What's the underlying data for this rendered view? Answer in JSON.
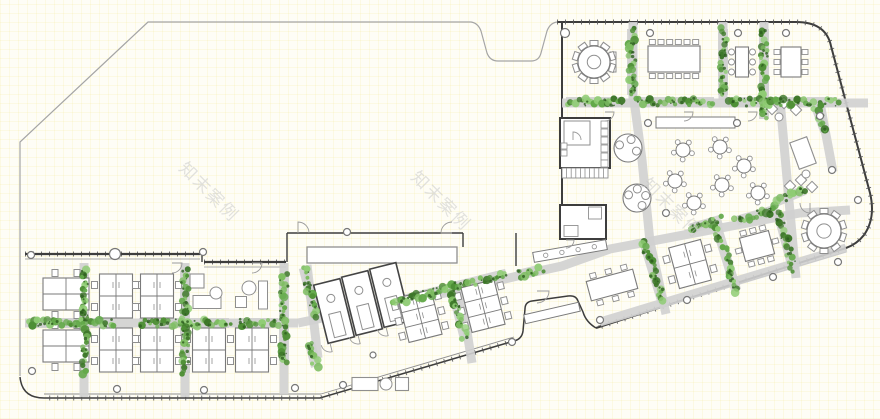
{
  "watermark": {
    "text": "知末案例",
    "color": "#c6c6c6",
    "opacity": 0.5,
    "font_size": 17,
    "rotation": 45,
    "instances": [
      [
        205,
        196
      ],
      [
        437,
        205
      ],
      [
        668,
        212
      ]
    ]
  },
  "palette": {
    "site_outline": "#a5a5a5",
    "wall_dark": "#3d3d3d",
    "wall_mid": "#555555",
    "furniture": "#8f8f8f",
    "furniture_dark": "#7a7a7a",
    "path_gray": "#d0d0d0",
    "greens": [
      "#4e8f35",
      "#63a94a",
      "#7dbd60",
      "#3c7628",
      "#8fcc74"
    ],
    "green_dark": "#2d5c1f",
    "white": "#ffffff"
  },
  "canvas": {
    "width": 880,
    "height": 419
  },
  "outline": {
    "site_path": "M20,376 L20,142 L148,22 L471,22 Q478,23 481,31 L487,53 Q490,61 498,61 L531,61 Q539,61 541,53 L547,31 Q550,23 557,22",
    "block_path": "M557,22 L796,22 Q826,22 831,46 L870,193 Q876,218 864,235 Q857,244 846,248 L596,328",
    "notch_path": "M596,328 Q586,322 583,312 L578,301 Q576,295 568,296 L532,301 Q525,302 525,309 L523,331 Q522,339 514,341",
    "bottom_path": "M514,341 L320,398 L44,398 Q22,398 20,377",
    "tick_paths": [
      "M557,22 L796,22 Q826,22 831,46 L870,193 Q876,218 864,235 Q857,244 846,248 L596,328",
      "M514,341 L320,398 L44,398",
      "M25,254 L200,254",
      "M204,262 L286,262"
    ]
  },
  "paths": [
    "M25,323 L298,323",
    "M84,263 L84,397",
    "M185,263 L185,397",
    "M284,263 L284,394",
    "M307,265 L318,358",
    "M460,288 L472,363",
    "M298,323 L455,291 L530,273 L562,266 L610,249 L800,213 L850,210",
    "M634,100 L642,160 L650,242 L666,314",
    "M780,100 L790,212 L796,278",
    "M562,103 L868,103",
    "M633,22 L633,100",
    "M723,22 L723,100",
    "M764,22 L764,100",
    "M820,103 L833,172",
    "M600,322 L846,248"
  ],
  "hedges": [
    [
      71,
      323,
      84,
      0
    ],
    [
      184,
      323,
      90,
      0
    ],
    [
      259,
      323,
      38,
      0
    ],
    [
      84,
      322,
      102,
      90
    ],
    [
      185,
      322,
      102,
      90
    ],
    [
      284,
      318,
      86,
      90
    ],
    [
      310,
      293,
      52,
      76
    ],
    [
      313,
      355,
      24,
      76
    ],
    [
      423,
      295,
      60,
      -14
    ],
    [
      458,
      311,
      58,
      76
    ],
    [
      481,
      280,
      52,
      -14
    ],
    [
      530,
      272,
      24,
      -14
    ],
    [
      653,
      271,
      64,
      73
    ],
    [
      726,
      257,
      70,
      73
    ],
    [
      786,
      242,
      58,
      75
    ],
    [
      706,
      224,
      32,
      -16
    ],
    [
      757,
      215,
      42,
      -16
    ],
    [
      790,
      196,
      32,
      -22
    ],
    [
      632,
      62,
      66,
      90
    ],
    [
      723,
      62,
      66,
      90
    ],
    [
      764,
      74,
      90,
      90
    ],
    [
      594,
      102,
      56,
      0
    ],
    [
      675,
      102,
      78,
      0
    ],
    [
      765,
      102,
      74,
      0
    ],
    [
      822,
      102,
      30,
      0
    ],
    [
      821,
      120,
      24,
      70
    ]
  ],
  "walls": [
    [
      562,
      22,
      562,
      232,
      2
    ],
    [
      25,
      254,
      200,
      254,
      2.2
    ],
    [
      25,
      259,
      200,
      259,
      0.8
    ],
    [
      202,
      254,
      202,
      262,
      1.4
    ],
    [
      204,
      262,
      286,
      262,
      2.2
    ],
    [
      204,
      267,
      286,
      267,
      0.8
    ],
    [
      287,
      233,
      287,
      262,
      1.4
    ],
    [
      287,
      233,
      463,
      233,
      1.4
    ],
    [
      463,
      233,
      463,
      247,
      1.4
    ],
    [
      335,
      247,
      335,
      263,
      0.9
    ],
    [
      370,
      247,
      370,
      263,
      0.9
    ],
    [
      406,
      247,
      406,
      263,
      0.9
    ],
    [
      432,
      247,
      432,
      263,
      0.9
    ],
    [
      310,
      259,
      454,
      259,
      0.7
    ],
    [
      516,
      233,
      516,
      266,
      1.4
    ],
    [
      846,
      252,
      598,
      326,
      0.9
    ],
    [
      514,
      337,
      321,
      394,
      0.9
    ],
    [
      321,
      394,
      44,
      394,
      0.9
    ]
  ],
  "clusters": [
    {
      "cx": 116,
      "cy": 296,
      "w": 33,
      "h": 44,
      "rot": 0,
      "rows": 2,
      "mode": "side"
    },
    {
      "cx": 157,
      "cy": 296,
      "w": 33,
      "h": 44,
      "rot": 0,
      "rows": 2,
      "mode": "side"
    },
    {
      "cx": 116,
      "cy": 350,
      "w": 33,
      "h": 44,
      "rot": 0,
      "rows": 2,
      "mode": "side"
    },
    {
      "cx": 157,
      "cy": 350,
      "w": 33,
      "h": 44,
      "rot": 0,
      "rows": 2,
      "mode": "side"
    },
    {
      "cx": 209,
      "cy": 350,
      "w": 33,
      "h": 44,
      "rot": 0,
      "rows": 2,
      "mode": "side"
    },
    {
      "cx": 252,
      "cy": 350,
      "w": 33,
      "h": 44,
      "rot": 0,
      "rows": 2,
      "mode": "side"
    },
    {
      "cx": 66,
      "cy": 294,
      "w": 46,
      "h": 32,
      "rot": 0,
      "rows": 2,
      "mode": "tb"
    },
    {
      "cx": 66,
      "cy": 346,
      "w": 46,
      "h": 32,
      "rot": 0,
      "rows": 2,
      "mode": "tb"
    },
    {
      "cx": 420,
      "cy": 316,
      "w": 34,
      "h": 46,
      "rot": -14,
      "rows": 3,
      "mode": "side"
    },
    {
      "cx": 483,
      "cy": 306,
      "w": 34,
      "h": 46,
      "rot": -14,
      "rows": 3,
      "mode": "side"
    },
    {
      "cx": 690,
      "cy": 264,
      "w": 33,
      "h": 42,
      "rot": -15,
      "rows": 2,
      "mode": "side"
    }
  ],
  "round_tables": [
    [
      594,
      62,
      16,
      10
    ],
    [
      824,
      231,
      17,
      10
    ]
  ],
  "cafe_big_tables": [
    [
      628,
      148,
      14,
      3
    ],
    [
      637,
      198,
      14,
      4
    ]
  ],
  "cafe_tables": [
    [
      683,
      150
    ],
    [
      720,
      147
    ],
    [
      675,
      181
    ],
    [
      722,
      185
    ],
    [
      694,
      203
    ],
    [
      758,
      193
    ],
    [
      744,
      166
    ]
  ],
  "conf_tables": [
    {
      "cx": 674,
      "cy": 59,
      "w": 52,
      "h": 26,
      "rot": 0,
      "t": 6,
      "b": 6,
      "l": 0,
      "r": 0,
      "style": "sq"
    },
    {
      "cx": 742,
      "cy": 62,
      "w": 13,
      "h": 30,
      "rot": 0,
      "t": 0,
      "b": 0,
      "l": 3,
      "r": 3,
      "style": "circ"
    },
    {
      "cx": 791,
      "cy": 62,
      "w": 20,
      "h": 30,
      "rot": 0,
      "t": 0,
      "b": 0,
      "l": 3,
      "r": 3,
      "style": "sq"
    },
    {
      "cx": 612,
      "cy": 285,
      "w": 48,
      "h": 20,
      "rot": -15,
      "t": 3,
      "b": 3,
      "l": 0,
      "r": 0,
      "style": "sq"
    },
    {
      "cx": 757,
      "cy": 246,
      "w": 30,
      "h": 24,
      "rot": -15,
      "t": 3,
      "b": 3,
      "l": 1,
      "r": 1,
      "style": "sq"
    }
  ],
  "counters": [
    {
      "cx": 695.5,
      "cy": 122.5,
      "w": 79,
      "h": 11,
      "rot": 0,
      "stools": 0
    },
    {
      "cx": 570,
      "cy": 251,
      "w": 74,
      "h": 10,
      "rot": -10,
      "stools": 4
    },
    {
      "cx": 552,
      "cy": 313,
      "w": 56,
      "h": 9,
      "rot": -13,
      "stools": 0
    }
  ],
  "phone_rooms": [
    [
      334,
      311,
      27,
      60,
      -14
    ],
    [
      362,
      303,
      27,
      60,
      -14
    ],
    [
      390,
      295,
      27,
      60,
      -14
    ]
  ],
  "misc_rects": [
    {
      "cx": 585,
      "cy": 143,
      "w": 50,
      "h": 50,
      "rot": 0,
      "s": 2
    },
    {
      "cx": 577,
      "cy": 133,
      "w": 26,
      "h": 24,
      "rot": 0,
      "s": 1
    },
    {
      "cx": 583,
      "cy": 222,
      "w": 46,
      "h": 34,
      "rot": 0,
      "s": 2
    },
    {
      "cx": 571,
      "cy": 231,
      "w": 14,
      "h": 11,
      "rot": 0,
      "s": 0.9
    },
    {
      "cx": 595,
      "cy": 213,
      "w": 13,
      "h": 12,
      "rot": 0,
      "s": 0.9
    },
    {
      "cx": 382,
      "cy": 255,
      "w": 150,
      "h": 16,
      "rot": 0,
      "s": 1.3
    },
    {
      "cx": 613,
      "cy": 62,
      "w": 6,
      "h": 20,
      "rot": 0,
      "s": 1
    },
    {
      "cx": 803,
      "cy": 153,
      "w": 18,
      "h": 28,
      "rot": -20,
      "s": 1.1
    },
    {
      "cx": 365,
      "cy": 384,
      "w": 26,
      "h": 13,
      "rot": 0,
      "s": 1.1
    },
    {
      "cx": 402,
      "cy": 384,
      "w": 13,
      "h": 13,
      "rot": 0,
      "s": 1.1
    },
    {
      "cx": 197,
      "cy": 281,
      "w": 14,
      "h": 14,
      "rot": 0,
      "s": 1.1
    },
    {
      "cx": 207,
      "cy": 302,
      "w": 28,
      "h": 13,
      "rot": 0,
      "s": 1
    },
    {
      "cx": 263,
      "cy": 295,
      "w": 9,
      "h": 28,
      "rot": 0,
      "s": 1
    },
    {
      "cx": 241,
      "cy": 302,
      "w": 11,
      "h": 11,
      "rot": 0,
      "s": 1
    },
    {
      "cx": 604.5,
      "cy": 124.5,
      "w": 7,
      "h": 7,
      "rot": 0,
      "s": 0.8
    },
    {
      "cx": 604.5,
      "cy": 132.5,
      "w": 7,
      "h": 7,
      "rot": 0,
      "s": 0.8
    },
    {
      "cx": 604.5,
      "cy": 140.5,
      "w": 7,
      "h": 7,
      "rot": 0,
      "s": 0.8
    },
    {
      "cx": 604.5,
      "cy": 148.5,
      "w": 7,
      "h": 7,
      "rot": 0,
      "s": 0.8
    },
    {
      "cx": 604.5,
      "cy": 156.5,
      "w": 7,
      "h": 7,
      "rot": 0,
      "s": 0.8
    },
    {
      "cx": 604.5,
      "cy": 163.5,
      "w": 7,
      "h": 7,
      "rot": 0,
      "s": 0.8
    },
    {
      "cx": 564,
      "cy": 146,
      "w": 6,
      "h": 6,
      "rot": 0,
      "s": 0.8
    },
    {
      "cx": 564,
      "cy": 153,
      "w": 6,
      "h": 6,
      "rot": 0,
      "s": 0.8
    },
    {
      "cx": 688,
      "cy": 122,
      "w": 5,
      "h": 4,
      "rot": 0,
      "s": 0.8
    },
    {
      "cx": 697,
      "cy": 122,
      "w": 5,
      "h": 4,
      "rot": 0,
      "s": 0.8
    },
    {
      "cx": 772,
      "cy": 109,
      "w": 8,
      "h": 8,
      "rot": 45,
      "s": 1
    },
    {
      "cx": 784,
      "cy": 103,
      "w": 8,
      "h": 8,
      "rot": 45,
      "s": 1
    },
    {
      "cx": 796,
      "cy": 110,
      "w": 8,
      "h": 8,
      "rot": 45,
      "s": 1
    },
    {
      "cx": 790,
      "cy": 186,
      "w": 8,
      "h": 8,
      "rot": 45,
      "s": 1
    },
    {
      "cx": 801,
      "cy": 180,
      "w": 8,
      "h": 8,
      "rot": 45,
      "s": 1
    },
    {
      "cx": 812,
      "cy": 187,
      "w": 8,
      "h": 8,
      "rot": 45,
      "s": 1
    }
  ],
  "misc_circles": [
    [
      779,
      117,
      4
    ],
    [
      806,
      174,
      4
    ],
    [
      216,
      293,
      6
    ],
    [
      249,
      288,
      7
    ],
    [
      386,
      384,
      6
    ]
  ],
  "columns": [
    [
      565,
      33,
      4.5
    ],
    [
      650,
      33,
      3.5
    ],
    [
      738,
      33,
      3.5
    ],
    [
      786,
      33,
      3.5
    ],
    [
      820,
      116,
      3.5
    ],
    [
      832,
      170,
      3.5
    ],
    [
      858,
      200,
      3.5
    ],
    [
      838,
      262,
      3.5
    ],
    [
      648,
      123,
      3.5
    ],
    [
      737,
      123,
      3.5
    ],
    [
      666,
      213,
      3.5
    ],
    [
      687,
      300,
      3.5
    ],
    [
      773,
      277,
      3.5
    ],
    [
      600,
      320,
      3.5
    ],
    [
      512,
      342,
      3.5
    ],
    [
      31,
      255,
      3.5
    ],
    [
      115,
      254,
      5.5
    ],
    [
      203,
      252,
      3.5
    ],
    [
      347,
      232,
      3.5
    ],
    [
      32,
      371,
      3.5
    ],
    [
      117,
      389,
      3.5
    ],
    [
      204,
      390,
      3.5
    ],
    [
      295,
      388,
      3.5
    ],
    [
      343,
      385,
      3.5
    ],
    [
      373,
      355,
      3
    ]
  ],
  "arcs": [
    [
      298,
      233,
      11,
      0
    ],
    [
      452,
      233,
      11,
      -90
    ],
    [
      605,
      112,
      9,
      90
    ],
    [
      684,
      112,
      9,
      90
    ],
    [
      748,
      112,
      9,
      90
    ],
    [
      537,
      291,
      12,
      90
    ],
    [
      172,
      263,
      10,
      90
    ],
    [
      252,
      263,
      10,
      90
    ],
    [
      573,
      140,
      8,
      0
    ],
    [
      566,
      240,
      8,
      90
    ],
    [
      810,
      203,
      10,
      180
    ],
    [
      330,
      343,
      9,
      166
    ],
    [
      358,
      335,
      9,
      166
    ],
    [
      386,
      327,
      9,
      166
    ]
  ],
  "stairs": {
    "x": 562,
    "y": 168,
    "w": 46,
    "h": 10,
    "n": 10
  }
}
